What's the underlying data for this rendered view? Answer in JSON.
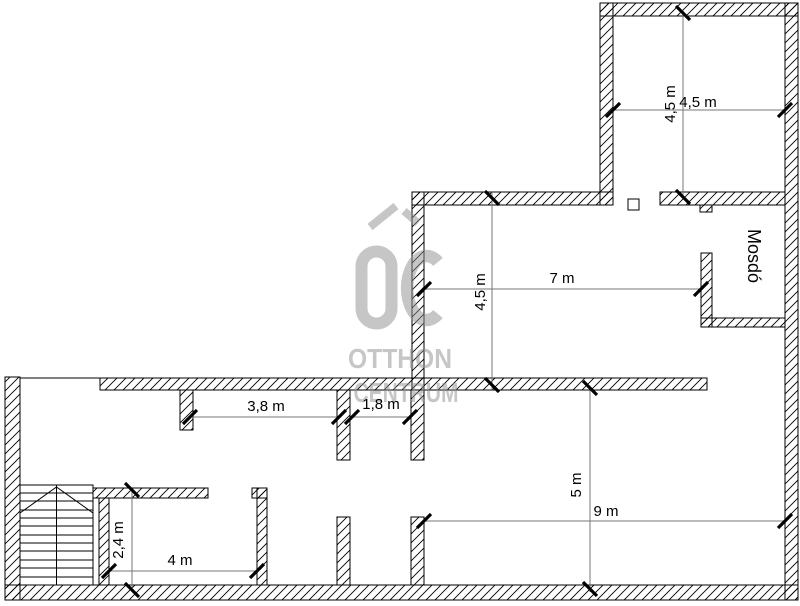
{
  "watermark": {
    "line1": "OTTHON",
    "line2": "CENTRUM"
  },
  "rooms": {
    "washroom": "Mosdó"
  },
  "dimensions": {
    "top_room_width": "4,5 m",
    "top_room_height": "4,5 m",
    "hall_width": "7 m",
    "hall_height": "4,5 m",
    "passage_left": "3,8 m",
    "passage_right": "1,8 m",
    "storage_height": "2,4 m",
    "storage_width": "4 m",
    "main_room_height": "5 m",
    "main_room_width": "9 m"
  },
  "colors": {
    "wall": "#000000",
    "dimension": "#777777",
    "watermark": "#8f8f8f"
  }
}
